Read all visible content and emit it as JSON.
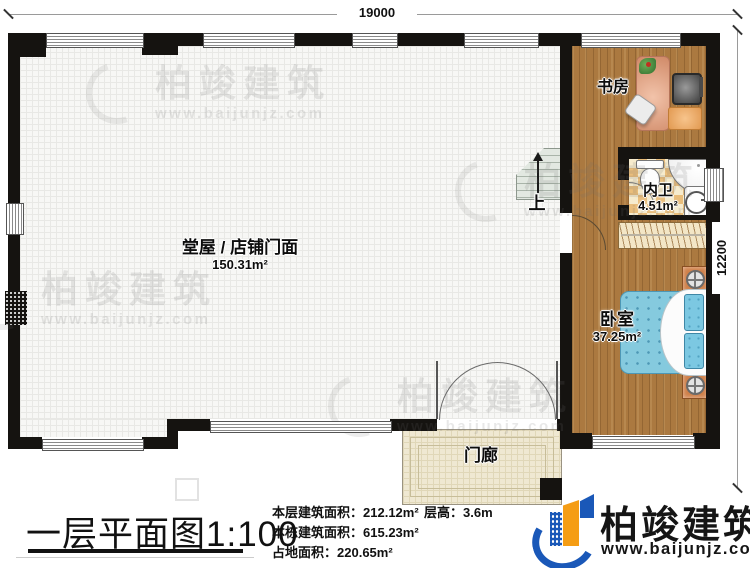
{
  "dimensions": {
    "top": "19000",
    "right": "12200"
  },
  "rooms": {
    "hall": {
      "name": "堂屋 / 店铺门面",
      "area": "150.31m²"
    },
    "study": {
      "name": "书房"
    },
    "bathroom": {
      "name": "内卫",
      "area": "4.51m²"
    },
    "bedroom": {
      "name": "卧室",
      "area": "37.25m²"
    },
    "porch": {
      "name": "门廊"
    }
  },
  "stairs": {
    "direction_label": "上"
  },
  "footer": {
    "title": "一层平面图1:100",
    "stats": [
      {
        "label": "本层建筑面积：",
        "value": "212.12m²"
      },
      {
        "label": "本栋建筑面积：",
        "value": "615.23m²"
      },
      {
        "label": "占地面积：",
        "value": "220.65m²"
      }
    ],
    "floor_height": {
      "label": "层高：",
      "value": "3.6m"
    }
  },
  "brand": {
    "name": "柏竣建筑",
    "website": "www.baijunjz.com"
  },
  "watermark": {
    "name": "柏竣建筑",
    "website": "www.baijunjz.com"
  },
  "colors": {
    "wall": "#151310",
    "wood": "#ab7940",
    "tile_light": "#f6ebcd",
    "tile_dark": "#e9bd7b",
    "bed_blue": "#85cade",
    "brand_blue": "#1a58b8",
    "brand_orange": "#f59d14",
    "porch": "#efe8d2"
  }
}
